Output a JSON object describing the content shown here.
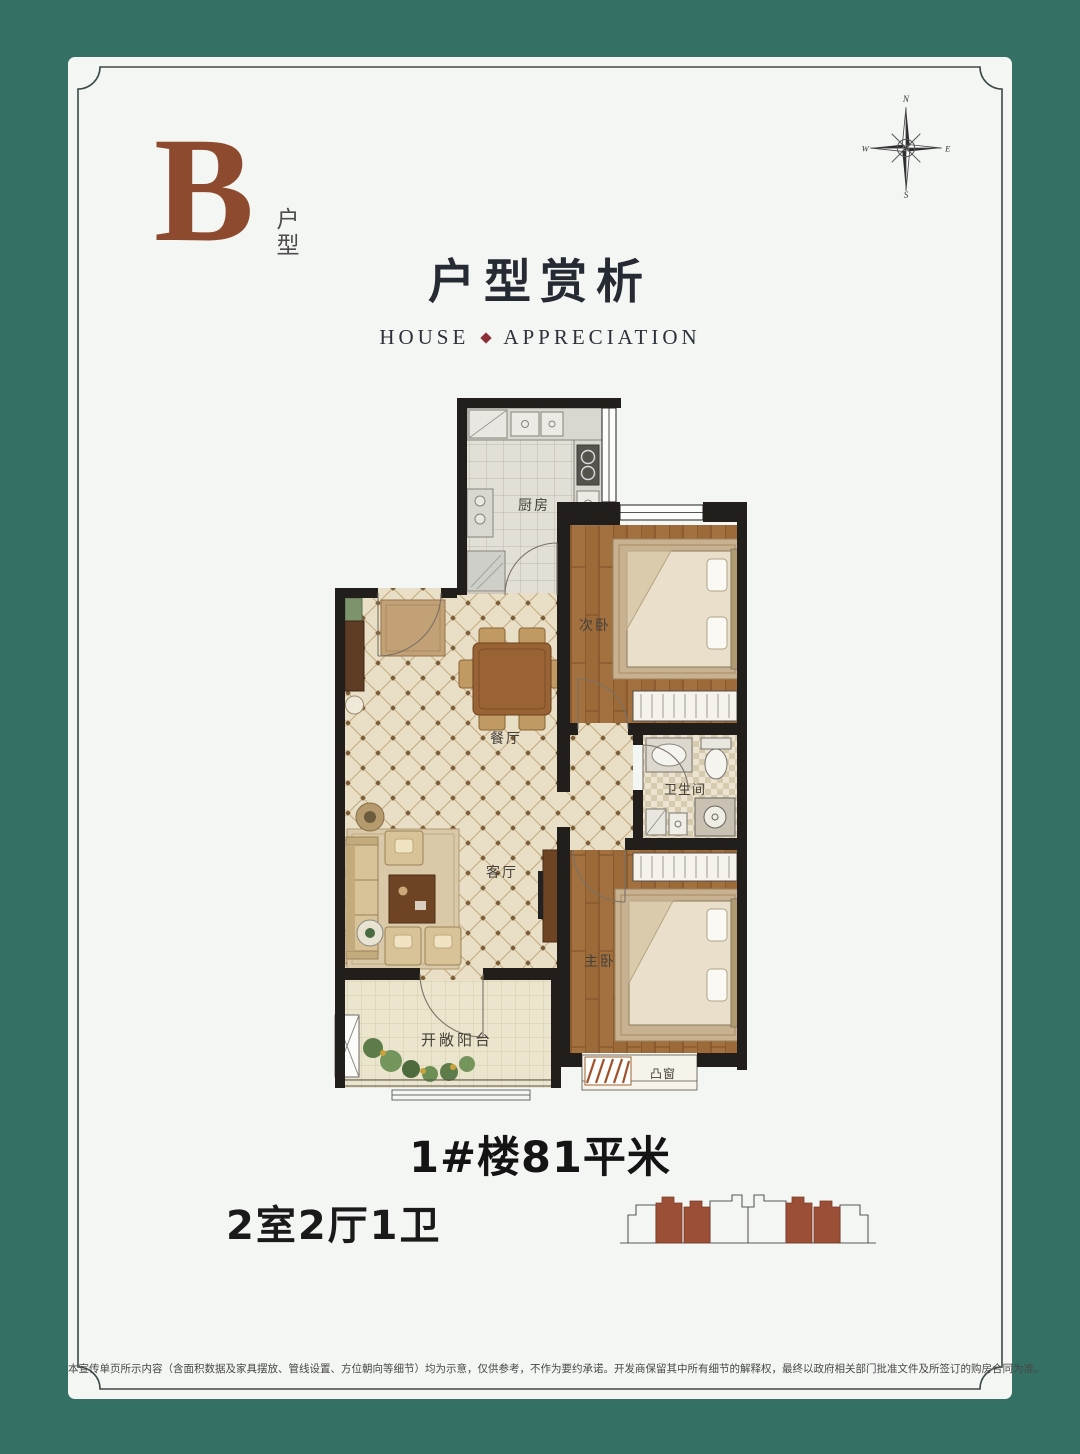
{
  "poster": {
    "type_badge": {
      "letter": "B",
      "suffix": "户型"
    },
    "header": {
      "title": "户型赏析",
      "subtitle_left": "HOUSE",
      "subtitle_right": "APPRECIATION"
    },
    "compass": {
      "n": "N",
      "e": "E",
      "s": "S",
      "w": "W"
    },
    "floorplan": {
      "rooms": [
        {
          "id": "kitchen",
          "label": "厨房"
        },
        {
          "id": "second-bedroom",
          "label": "次卧"
        },
        {
          "id": "bathroom",
          "label": "卫生间"
        },
        {
          "id": "dining",
          "label": "餐厅"
        },
        {
          "id": "living",
          "label": "客厅"
        },
        {
          "id": "master-bedroom",
          "label": "主卧"
        },
        {
          "id": "balcony",
          "label": "开敞阳台"
        },
        {
          "id": "bay-window",
          "label": "凸窗"
        }
      ]
    },
    "info": {
      "building_area": "1#楼81平米",
      "layout": "2室2厅1卫"
    },
    "footer": {
      "disclaimer": "本宣传单页所示内容（含面积数据及家具摆放、管线设置、方位朝向等细节）均为示意，仅供参考，不作为要约承诺。开发商保留其中所有细节的解释权，最终以政府相关部门批准文件及所签订的购房合同为准。"
    },
    "colors": {
      "frame_teal": "#357065",
      "badge_brown": "#8e4a2f",
      "accent_red": "#8b2e39",
      "building_fill": "#9b4f36",
      "wall_black": "#211e1b"
    }
  }
}
